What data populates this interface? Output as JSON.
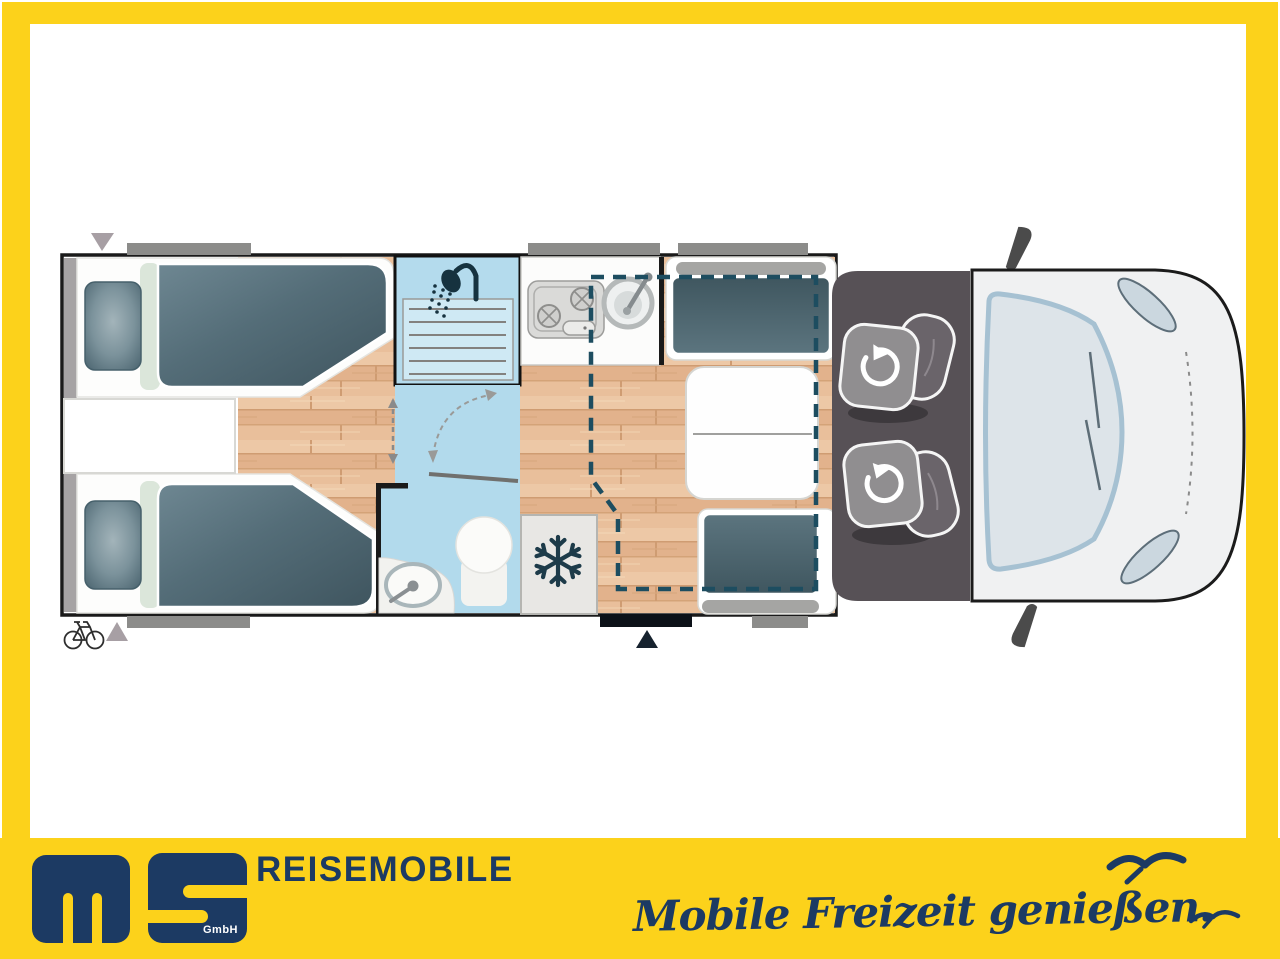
{
  "brand": {
    "gmbh_label": "GmbH",
    "division_label": "REISEMOBILE",
    "slogan_text": "Mobile Freizeit genießen."
  },
  "palette": {
    "frame_yellow": "#fcd21b",
    "brand_navy": "#1c3a63",
    "wood_floor": "#e8c09e",
    "bathroom_blue": "#b2daec",
    "upholstery_slate": "#546d78",
    "cab_gray": "#575156",
    "dashed_bed_outline": "#1d4d60"
  },
  "floorplan": {
    "type": "motorhome-top-view-floor-plan",
    "icons": [
      "shower-icon",
      "snowflake-icon",
      "swivel-seat-arrow-icon",
      "bicycle-icon",
      "entry-arrow-icon",
      "door-swing-arc",
      "window-marker",
      "mirror-icon"
    ]
  }
}
